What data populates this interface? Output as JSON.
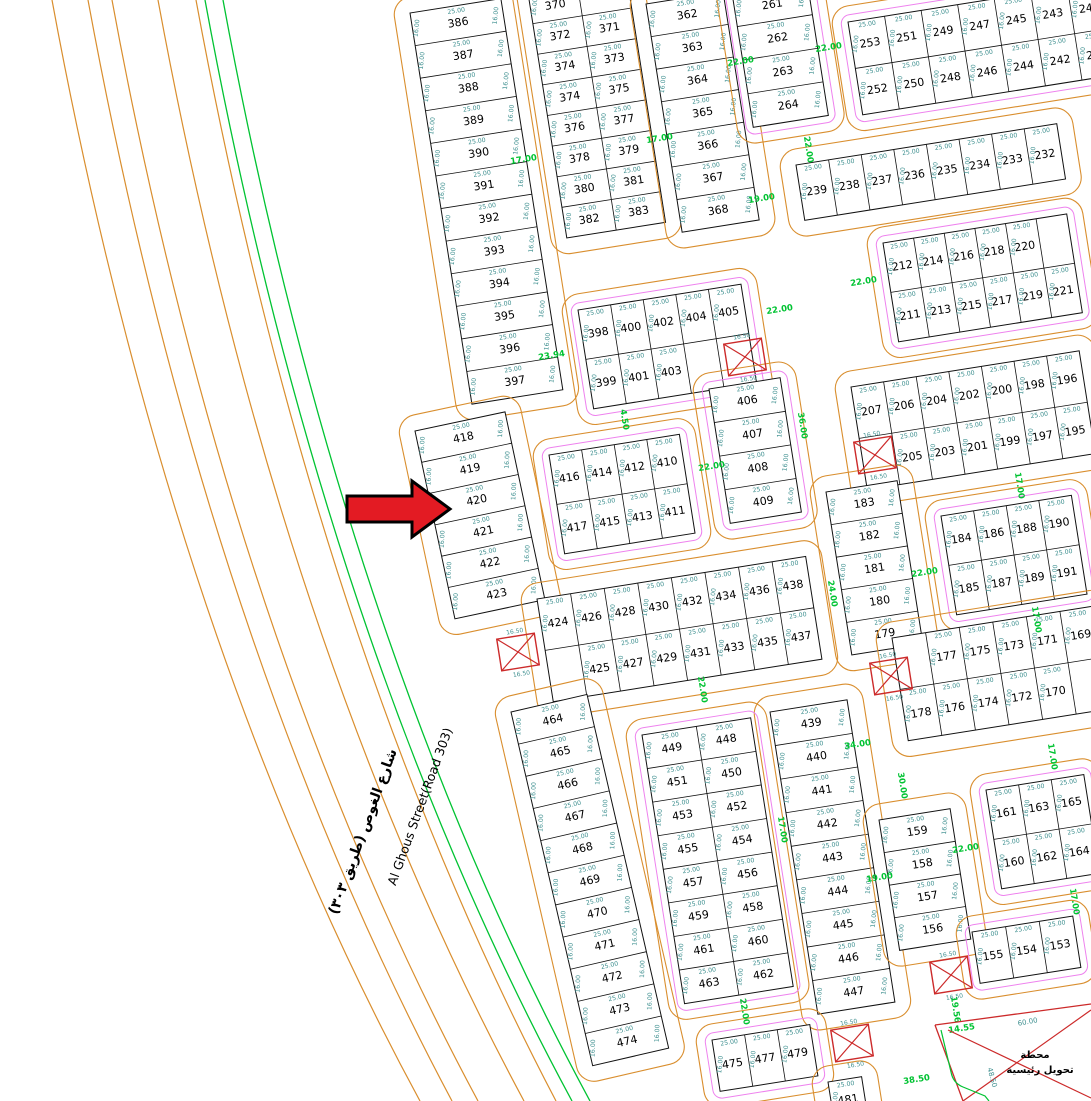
{
  "map": {
    "street": {
      "name_en": "Al Ghous Street(Road 303)",
      "name_ar": "شارع الغوص (طريق ٣٠٣)"
    },
    "station": {
      "label_line1": "محطة",
      "label_line2": "تحويل رئيسية",
      "dim_top": "60.00",
      "dim_side": "48.50"
    },
    "dims": {
      "top": "25.00",
      "side": "16.00",
      "xbox": "16.50"
    },
    "colors": {
      "road": "#d98e2e",
      "green": "#00c332",
      "teal": "#3f9090",
      "magenta": "#ee82ee",
      "red": "#cc2a2a",
      "arrow": "#e31b23",
      "ink": "#111111"
    },
    "blocks": [
      {
        "id": "col-386",
        "x": 410,
        "y": 13,
        "rot": -9,
        "cw": 92,
        "ch": 33,
        "magenta": false,
        "rows": [
          [
            386
          ],
          [
            387
          ],
          [
            388
          ],
          [
            389
          ],
          [
            390
          ],
          [
            391
          ],
          [
            392
          ],
          [
            393
          ],
          [
            394
          ],
          [
            395
          ],
          [
            396
          ],
          [
            397
          ]
        ]
      },
      {
        "id": "col-418",
        "x": 415,
        "y": 431,
        "rot": -12,
        "cw": 92,
        "ch": 32,
        "magenta": false,
        "rows": [
          [
            418
          ],
          [
            419
          ],
          [
            420
          ],
          [
            421
          ],
          [
            422
          ],
          [
            423
          ]
        ]
      },
      {
        "id": "blk-370",
        "x": 528,
        "y": -7,
        "rot": -9,
        "cw": 50,
        "ch": 31,
        "magenta": false,
        "rows": [
          [
            370,
            null
          ],
          [
            372,
            371
          ],
          [
            374,
            373
          ],
          [
            374,
            375
          ],
          [
            376,
            377
          ],
          [
            378,
            379
          ],
          [
            380,
            381
          ],
          [
            382,
            383
          ]
        ]
      },
      {
        "id": "col-362",
        "x": 646,
        "y": 4,
        "rot": -9,
        "cw": 78,
        "ch": 33,
        "magenta": false,
        "rows": [
          [
            362
          ],
          [
            363
          ],
          [
            364
          ],
          [
            365
          ],
          [
            366
          ],
          [
            367
          ],
          [
            368
          ]
        ]
      },
      {
        "id": "col-261",
        "x": 732,
        "y": -7,
        "rot": -9,
        "cw": 76,
        "ch": 34,
        "magenta": true,
        "rows": [
          [
            261
          ],
          [
            262
          ],
          [
            263
          ],
          [
            264
          ]
        ]
      },
      {
        "id": "blk-249",
        "x": 848,
        "y": 22,
        "rot": -9,
        "cw": 37,
        "ch": 47,
        "magenta": true,
        "rows": [
          [
            253,
            251,
            249,
            247,
            245,
            243,
            241
          ],
          [
            252,
            250,
            248,
            246,
            244,
            242,
            240
          ]
        ]
      },
      {
        "id": "row-232",
        "x": 796,
        "y": 165,
        "rot": -9,
        "cw": 33,
        "ch": 56,
        "magenta": false,
        "rows": [
          [
            239,
            238,
            237,
            236,
            235,
            234,
            233,
            232
          ]
        ]
      },
      {
        "id": "blk-212",
        "x": 883,
        "y": 243,
        "rot": -9,
        "cw": 31,
        "ch": 50,
        "magenta": true,
        "rows": [
          [
            212,
            214,
            216,
            218,
            220,
            null
          ],
          [
            211,
            213,
            215,
            217,
            219,
            221
          ]
        ]
      },
      {
        "id": "blk-196",
        "x": 851,
        "y": 387,
        "rot": -9,
        "cw": 33,
        "ch": 52,
        "magenta": false,
        "rows": [
          [
            207,
            206,
            204,
            202,
            200,
            198,
            196
          ],
          [
            null,
            205,
            203,
            201,
            199,
            197,
            195
          ]
        ]
      },
      {
        "id": "blk-398",
        "x": 578,
        "y": 310,
        "rot": -9,
        "cw": 33,
        "ch": 50,
        "magenta": true,
        "rows": [
          [
            398,
            400,
            402,
            404,
            405
          ],
          [
            399,
            401,
            403,
            null,
            null
          ]
        ]
      },
      {
        "id": "blk-412",
        "x": 549,
        "y": 455,
        "rot": -9,
        "cw": 33,
        "ch": 50,
        "magenta": true,
        "rows": [
          [
            416,
            414,
            412,
            410
          ],
          [
            417,
            415,
            413,
            411
          ]
        ]
      },
      {
        "id": "col-406",
        "x": 709,
        "y": 389,
        "rot": -9,
        "cw": 72,
        "ch": 34,
        "magenta": true,
        "rows": [
          [
            406
          ],
          [
            407
          ],
          [
            408
          ],
          [
            409
          ]
        ]
      },
      {
        "id": "blk-424",
        "x": 537,
        "y": 599,
        "rot": -9,
        "cw": 34,
        "ch": 52,
        "magenta": false,
        "rows": [
          [
            424,
            426,
            428,
            430,
            432,
            434,
            436,
            438
          ],
          [
            null,
            425,
            427,
            429,
            431,
            433,
            435,
            437
          ]
        ]
      },
      {
        "id": "col-439",
        "x": 770,
        "y": 712,
        "rot": -9,
        "cw": 78,
        "ch": 34,
        "magenta": false,
        "rows": [
          [
            439
          ],
          [
            440
          ],
          [
            441
          ],
          [
            442
          ],
          [
            443
          ],
          [
            444
          ],
          [
            445
          ],
          [
            446
          ],
          [
            447
          ]
        ]
      },
      {
        "id": "col-464",
        "x": 511,
        "y": 712,
        "rot": -13,
        "cw": 78,
        "ch": 33,
        "magenta": false,
        "rows": [
          [
            464
          ],
          [
            465
          ],
          [
            466
          ],
          [
            467
          ],
          [
            468
          ],
          [
            469
          ],
          [
            470
          ],
          [
            471
          ],
          [
            472
          ],
          [
            473
          ],
          [
            474
          ]
        ]
      },
      {
        "id": "blk-448",
        "x": 642,
        "y": 735,
        "rot": -9,
        "cw": 55,
        "ch": 34,
        "magenta": true,
        "rows": [
          [
            449,
            448
          ],
          [
            451,
            450
          ],
          [
            453,
            452
          ],
          [
            455,
            454
          ],
          [
            457,
            456
          ],
          [
            459,
            458
          ],
          [
            461,
            460
          ],
          [
            463,
            462
          ]
        ]
      },
      {
        "id": "blk-475",
        "x": 712,
        "y": 1040,
        "rot": -9,
        "cw": 33,
        "ch": 52,
        "magenta": true,
        "rows": [
          [
            475,
            477,
            479
          ]
        ]
      },
      {
        "id": "cell-481",
        "x": 828,
        "y": 1082,
        "rot": -9,
        "cw": 34,
        "ch": 40,
        "magenta": false,
        "rows": [
          [
            481
          ]
        ]
      },
      {
        "id": "col-179",
        "x": 826,
        "y": 492,
        "rot": -9,
        "cw": 72,
        "ch": 33,
        "magenta": false,
        "rows": [
          [
            183
          ],
          [
            182
          ],
          [
            181
          ],
          [
            180
          ],
          [
            179
          ]
        ]
      },
      {
        "id": "blk-184",
        "x": 941,
        "y": 516,
        "rot": -9,
        "cw": 33,
        "ch": 50,
        "magenta": true,
        "rows": [
          [
            184,
            186,
            188,
            190
          ],
          [
            185,
            187,
            189,
            191
          ]
        ]
      },
      {
        "id": "blk-171",
        "x": 892,
        "y": 638,
        "rot": -9,
        "cw": 34,
        "ch": 52,
        "magenta": false,
        "rows": [
          [
            null,
            177,
            175,
            173,
            171,
            169
          ],
          [
            178,
            176,
            174,
            172,
            170,
            null
          ]
        ]
      },
      {
        "id": "blk-161",
        "x": 986,
        "y": 790,
        "rot": -9,
        "cw": 33,
        "ch": 50,
        "magenta": true,
        "rows": [
          [
            161,
            163,
            165
          ],
          [
            160,
            162,
            164
          ]
        ]
      },
      {
        "id": "col-156",
        "x": 879,
        "y": 820,
        "rot": -9,
        "cw": 72,
        "ch": 33,
        "magenta": false,
        "rows": [
          [
            159
          ],
          [
            158
          ],
          [
            157
          ],
          [
            156
          ]
        ]
      },
      {
        "id": "row-153",
        "x": 972,
        "y": 932,
        "rot": -9,
        "cw": 34,
        "ch": 52,
        "magenta": true,
        "rows": [
          [
            155,
            154,
            153
          ]
        ]
      }
    ],
    "green_labels": [
      {
        "t": "17.00",
        "x": 524,
        "y": 162,
        "r": -9
      },
      {
        "t": "17.00",
        "x": 660,
        "y": 141,
        "r": -9
      },
      {
        "t": "22.00",
        "x": 741,
        "y": 64,
        "r": -9
      },
      {
        "t": "22.00",
        "x": 829,
        "y": 50,
        "r": -9
      },
      {
        "t": "19.00",
        "x": 762,
        "y": 201,
        "r": -9
      },
      {
        "t": "22.00",
        "x": 806,
        "y": 150,
        "r": 81
      },
      {
        "t": "22.00",
        "x": 864,
        "y": 284,
        "r": -9
      },
      {
        "t": "23.94",
        "x": 552,
        "y": 358,
        "r": -9
      },
      {
        "t": "22.00",
        "x": 780,
        "y": 312,
        "r": -9
      },
      {
        "t": "36.00",
        "x": 800,
        "y": 426,
        "r": 81
      },
      {
        "t": "4.50",
        "x": 622,
        "y": 420,
        "r": 81
      },
      {
        "t": "22.00",
        "x": 712,
        "y": 469,
        "r": -9
      },
      {
        "t": "17.00",
        "x": 1017,
        "y": 486,
        "r": 81
      },
      {
        "t": "22.00",
        "x": 925,
        "y": 575,
        "r": -9
      },
      {
        "t": "17.00",
        "x": 1034,
        "y": 620,
        "r": 81
      },
      {
        "t": "22.00",
        "x": 700,
        "y": 690,
        "r": 81
      },
      {
        "t": "24.00",
        "x": 830,
        "y": 594,
        "r": 81
      },
      {
        "t": "34.00",
        "x": 858,
        "y": 747,
        "r": -9
      },
      {
        "t": "30.00",
        "x": 900,
        "y": 786,
        "r": 81
      },
      {
        "t": "19.00",
        "x": 880,
        "y": 880,
        "r": -9
      },
      {
        "t": "22.00",
        "x": 966,
        "y": 851,
        "r": -9
      },
      {
        "t": "17.00",
        "x": 1050,
        "y": 757,
        "r": 81
      },
      {
        "t": "17.00",
        "x": 1072,
        "y": 902,
        "r": 81
      },
      {
        "t": "17.00",
        "x": 780,
        "y": 830,
        "r": 81
      },
      {
        "t": "22.00",
        "x": 742,
        "y": 1012,
        "r": 81
      },
      {
        "t": "19.56",
        "x": 953,
        "y": 1010,
        "r": 81
      },
      {
        "t": "38.50",
        "x": 917,
        "y": 1082,
        "r": -9
      },
      {
        "t": "14.55",
        "x": 962,
        "y": 1031,
        "r": -9
      }
    ],
    "x_boxes": [
      {
        "x": 518,
        "y": 652
      },
      {
        "x": 745,
        "y": 357
      },
      {
        "x": 875,
        "y": 455
      },
      {
        "x": 891,
        "y": 676
      },
      {
        "x": 852,
        "y": 1043
      },
      {
        "x": 951,
        "y": 975
      }
    ]
  }
}
